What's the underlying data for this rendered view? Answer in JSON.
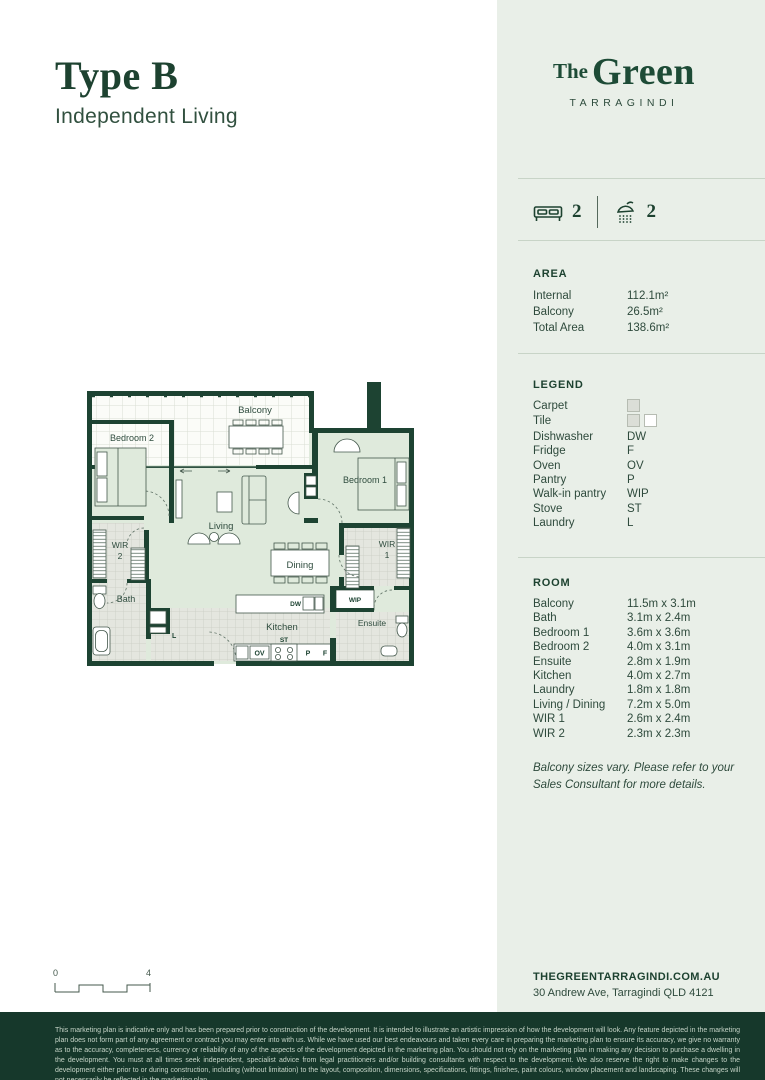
{
  "page": {
    "title": "Type B",
    "subtitle": "Independent Living"
  },
  "brand": {
    "the": "The",
    "green": "Green",
    "location": "TARRAGINDI"
  },
  "stats": {
    "beds": "2",
    "baths": "2"
  },
  "area": {
    "heading": "AREA",
    "rows": [
      {
        "label": "Internal",
        "value": "112.1m²"
      },
      {
        "label": "Balcony",
        "value": "26.5m²"
      },
      {
        "label": "Total Area",
        "value": "138.6m²"
      }
    ]
  },
  "legend": {
    "heading": "LEGEND",
    "rows": [
      {
        "label": "Carpet",
        "value": "",
        "swatch": "carpet"
      },
      {
        "label": "Tile",
        "value": "",
        "swatch": "tile"
      },
      {
        "label": "Dishwasher",
        "value": "DW"
      },
      {
        "label": "Fridge",
        "value": "F"
      },
      {
        "label": "Oven",
        "value": "OV"
      },
      {
        "label": "Pantry",
        "value": "P"
      },
      {
        "label": "Walk-in pantry",
        "value": "WIP"
      },
      {
        "label": "Stove",
        "value": "ST"
      },
      {
        "label": "Laundry",
        "value": "L"
      }
    ]
  },
  "rooms": {
    "heading": "ROOM",
    "rows": [
      {
        "label": "Balcony",
        "value": "11.5m x 3.1m"
      },
      {
        "label": "Bath",
        "value": "3.1m x 2.4m"
      },
      {
        "label": "Bedroom 1",
        "value": "3.6m x 3.6m"
      },
      {
        "label": "Bedroom 2",
        "value": "4.0m x 3.1m"
      },
      {
        "label": "Ensuite",
        "value": "2.8m x 1.9m"
      },
      {
        "label": "Kitchen",
        "value": "4.0m x 2.7m"
      },
      {
        "label": "Laundry",
        "value": "1.8m x 1.8m"
      },
      {
        "label": "Living / Dining",
        "value": "7.2m x 5.0m"
      },
      {
        "label": "WIR 1",
        "value": "2.6m x 2.4m"
      },
      {
        "label": "WIR 2",
        "value": "2.3m x 2.3m"
      }
    ]
  },
  "note": {
    "text": "Balcony sizes vary. Please refer to your Sales Consultant for more details."
  },
  "contact": {
    "website": "THEGREENTARRAGINDI.COM.AU",
    "address": "30 Andrew Ave, Tarragindi QLD 4121"
  },
  "scale": {
    "start": "0",
    "end": "4"
  },
  "plan": {
    "labels": {
      "balcony": "Balcony",
      "bedroom2": "Bedroom 2",
      "bedroom1": "Bedroom 1",
      "living": "Living",
      "dining": "Dining",
      "wir": "WIR",
      "wir2num": "2",
      "wir1num": "1",
      "bath": "Bath",
      "kitchen": "Kitchen",
      "ensuite": "Ensuite",
      "wip": "WIP",
      "dw": "DW",
      "laundry": "L",
      "ov": "OV",
      "st": "ST",
      "p": "P",
      "f": "F"
    }
  },
  "footer": {
    "disclaimer": "This marketing plan is indicative only and has been prepared prior to construction of the development. It is intended to illustrate an artistic impression of how the development will look. Any feature depicted in the marketing plan does not form part of any agreement or contract you may enter into with us. While we have used our best endeavours and taken every care in preparing the marketing plan to ensure its accuracy, we give no warranty as to the accuracy, completeness, currency or reliability of any of the aspects of the development depicted in the marketing plan. You should not rely on the marketing plan in making any decision to purchase a dwelling in the development. You must at all times seek independent, specialist advice from legal practitioners and/or building consultants with respect to the development. We also reserve the right to make changes to the development either prior to or during construction, including (without limitation) to the layout, composition, dimensions, specifications, fittings, finishes, paint colours, window placement and landscaping. These changes will not necessarily be reflected in the marketing plan."
  },
  "colors": {
    "accent": "#1D4332",
    "panel_bg": "#E9EFE8",
    "footer_bg": "#16382B",
    "carpet_fill": "#DFEADC",
    "tile_fill": "#E4E6DF"
  }
}
